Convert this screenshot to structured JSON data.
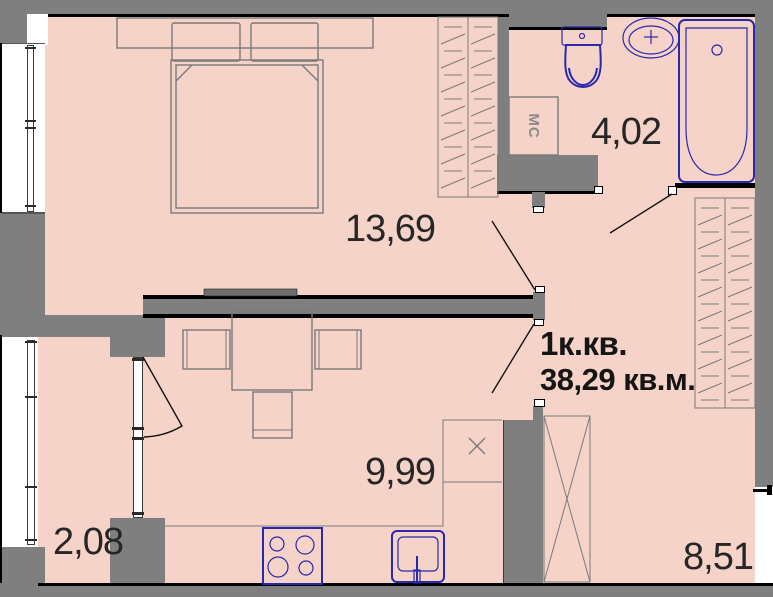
{
  "plan": {
    "title_line1": "1к.кв.",
    "title_line2": "38,29 кв.м.",
    "rooms": [
      {
        "name": "bedroom",
        "area": "13,69"
      },
      {
        "name": "bathroom",
        "area": "4,02"
      },
      {
        "name": "kitchen-living",
        "area": "9,99"
      },
      {
        "name": "balcony",
        "area": "2,08"
      },
      {
        "name": "hallway",
        "area": "8,51"
      }
    ],
    "labels": {
      "washing_machine": "МС"
    },
    "colors": {
      "floor": "#f6d3c9",
      "wall": "#7f7f7f",
      "outline": "#000000",
      "line": "#7a7a7a",
      "fixture": "#2a28ad",
      "text": "#262626"
    }
  }
}
